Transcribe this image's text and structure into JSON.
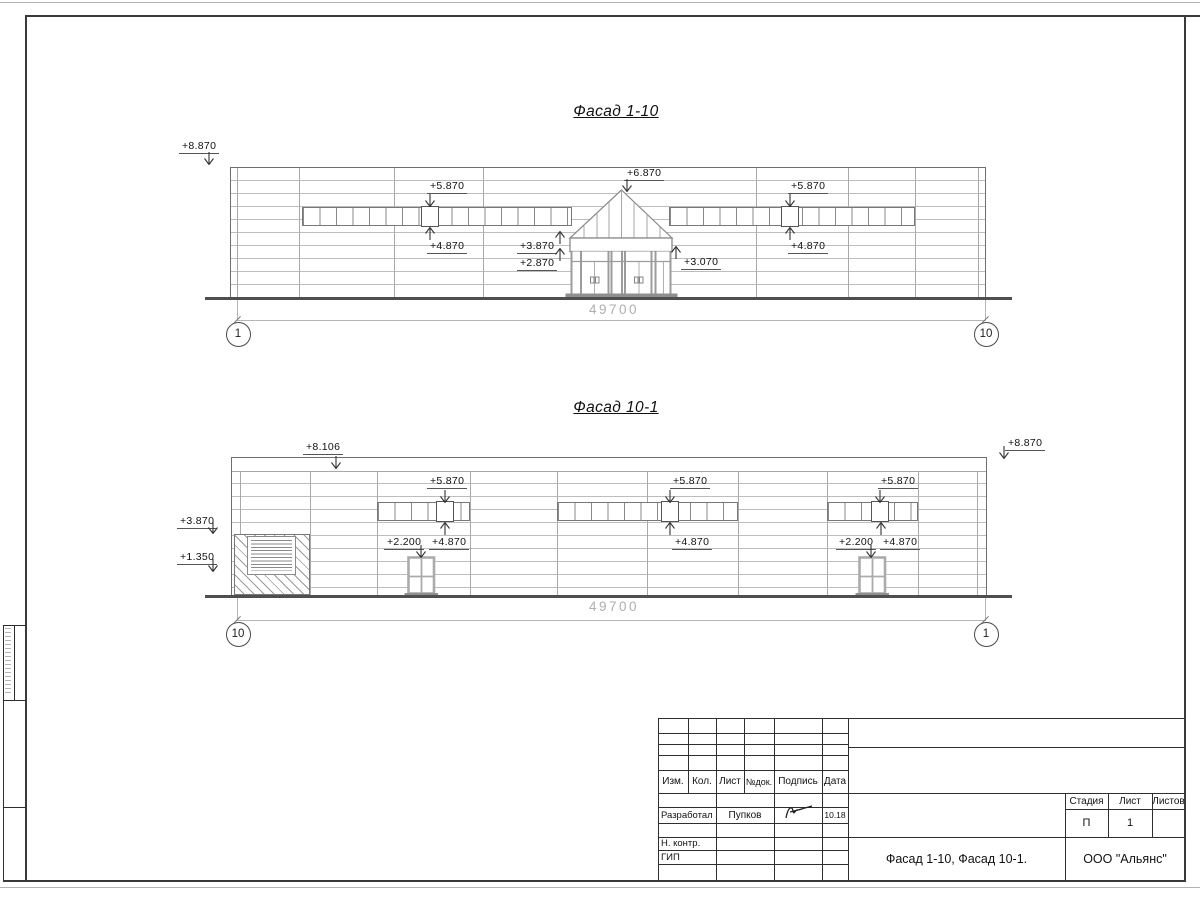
{
  "drawing": {
    "facade_top": {
      "title": "Фасад 1-10",
      "dim": "49700",
      "axis_left": "1",
      "axis_right": "10",
      "marks": {
        "m8870": "+8.870",
        "m5870L": "+5.870",
        "m6870": "+6.870",
        "m5870R": "+5.870",
        "m4870L": "+4.870",
        "m3870": "+3.870",
        "m2870": "+2.870",
        "m3070": "+3.070",
        "m4870R": "+4.870"
      }
    },
    "facade_bottom": {
      "title": "Фасад 10-1",
      "dim": "49700",
      "axis_left": "10",
      "axis_right": "1",
      "marks": {
        "m8106": "+8.106",
        "m8870": "+8.870",
        "m3870": "+3.870",
        "m1350": "+1.350",
        "m5870a": "+5.870",
        "m5870b": "+5.870",
        "m5870c": "+5.870",
        "m4870a": "+4.870",
        "m4870b": "+4.870",
        "m4870c": "+4.870",
        "m2200a": "+2.200",
        "m2200b": "+2.200"
      }
    }
  },
  "title_block": {
    "cols": {
      "izm": "Изм.",
      "kol": "Кол.",
      "list": "Лист",
      "ndok": "№док.",
      "podpis": "Подпись",
      "data": "Дата"
    },
    "row_developer": {
      "role": "Разработал",
      "name": "Пупков",
      "date": "10.18"
    },
    "row_ncontr": {
      "role": "Н. контр."
    },
    "row_gip": {
      "role": "ГИП"
    },
    "stage": {
      "label": "Стадия",
      "value": "П"
    },
    "sheet": {
      "label": "Лист",
      "value": "1"
    },
    "sheets": {
      "label": "Листов",
      "value": ""
    },
    "doc_name": "Фасад 1-10, Фасад 10-1.",
    "company": "ООО \"Альянс\""
  }
}
